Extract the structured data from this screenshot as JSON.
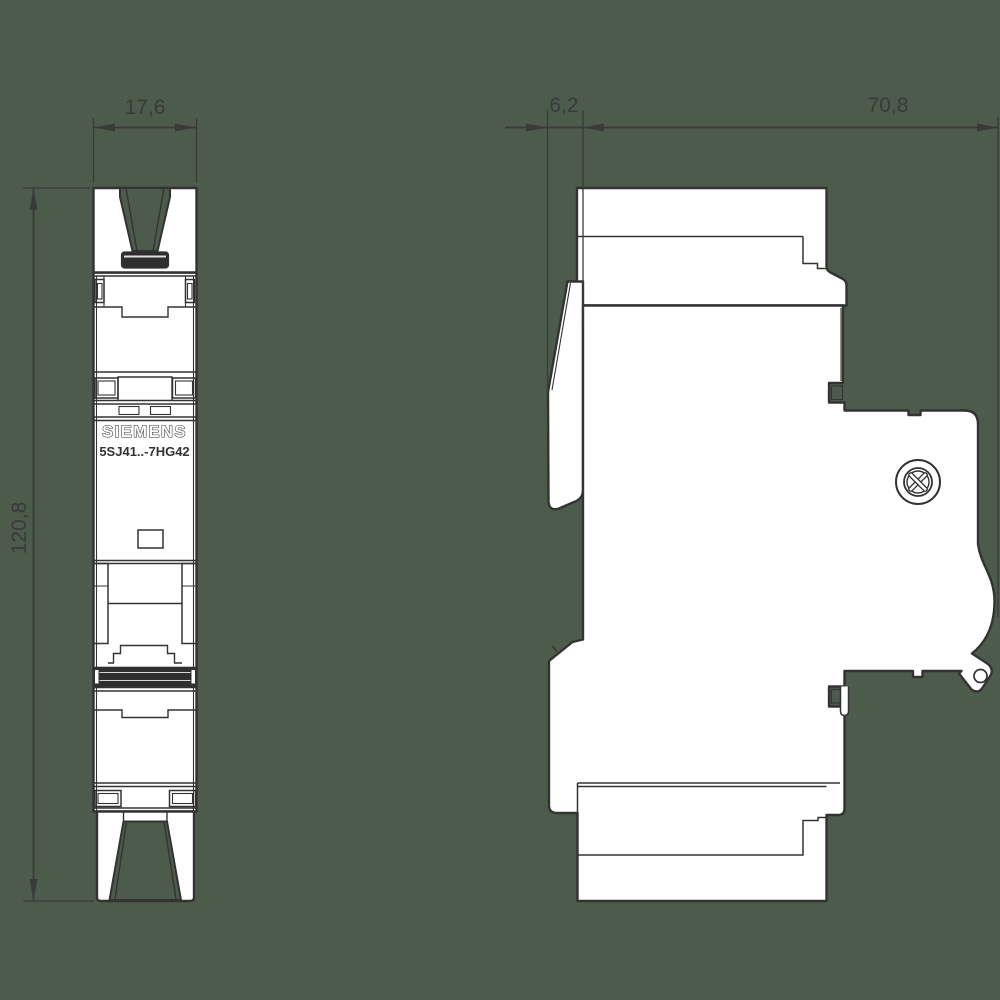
{
  "labels": {
    "brand": "SIEMENS",
    "model": "5SJ41..-7HG42"
  },
  "dimensions": {
    "front_width": "17,6",
    "front_height": "120,8",
    "side_offset": "6,2",
    "side_depth": "70,8"
  },
  "colors": {
    "background": "#4d5b4d",
    "line": "#333333",
    "fill": "#ffffff",
    "toggle_band": "#2e2e2e",
    "dim_text": "#3a3a3a"
  }
}
